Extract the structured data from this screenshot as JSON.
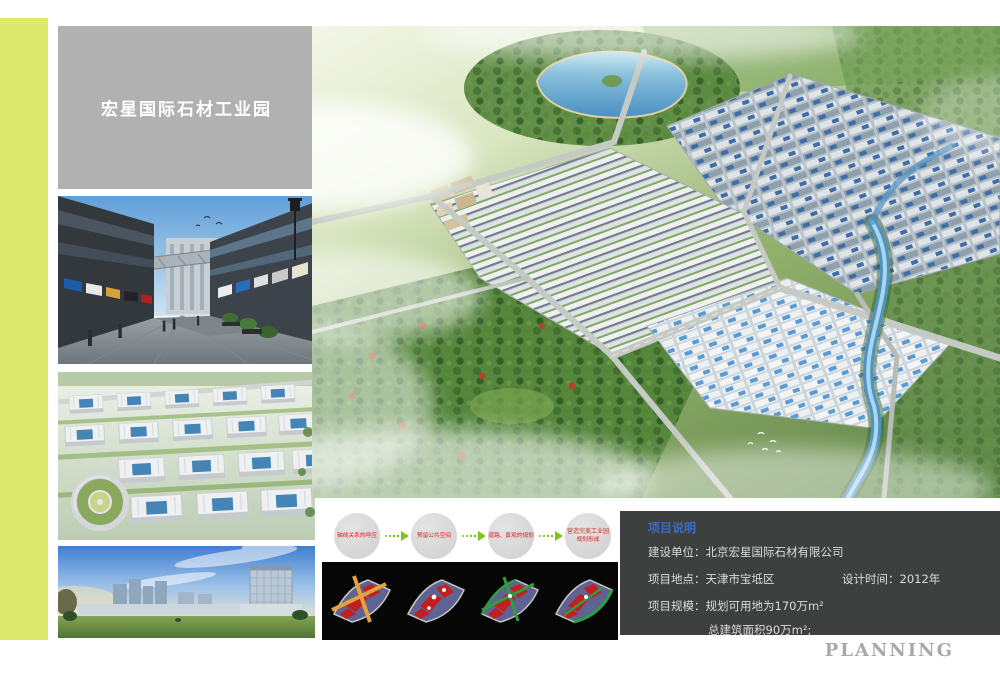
{
  "page": {
    "watermark": "PLANNING"
  },
  "title_box": {
    "title": "宏星国际石材工业园"
  },
  "flow": {
    "steps": [
      {
        "label": "轴线关系的呼应"
      },
      {
        "label": "预留公共空间"
      },
      {
        "label": "道路、景观的规划"
      },
      {
        "label": "营造完美工业园",
        "sublabel": "规划形成"
      }
    ]
  },
  "info_box": {
    "title": "项目说明",
    "rows": [
      {
        "label": "建设单位：",
        "value": "北京宏星国际石材有限公司"
      },
      {
        "label": "项目地点：",
        "value": "天津市宝坻区",
        "label2": "设计时间：",
        "value2": "2012年"
      },
      {
        "label": "项目规模：",
        "value": "规划可用地为170万m²"
      },
      {
        "label": "",
        "value": "总建筑面积90万m²;"
      }
    ]
  },
  "colors": {
    "accent_stripe": "#dde96c",
    "title_box_bg": "#b1b1b1",
    "info_box_bg": "#3d403f",
    "info_title": "#3e6cbd",
    "flow_text_red": "#e01919",
    "flow_arrow_green": "#7fc31c",
    "diagram_strip_bg": "#060606",
    "watermark_gray": "#a9a9a9"
  }
}
